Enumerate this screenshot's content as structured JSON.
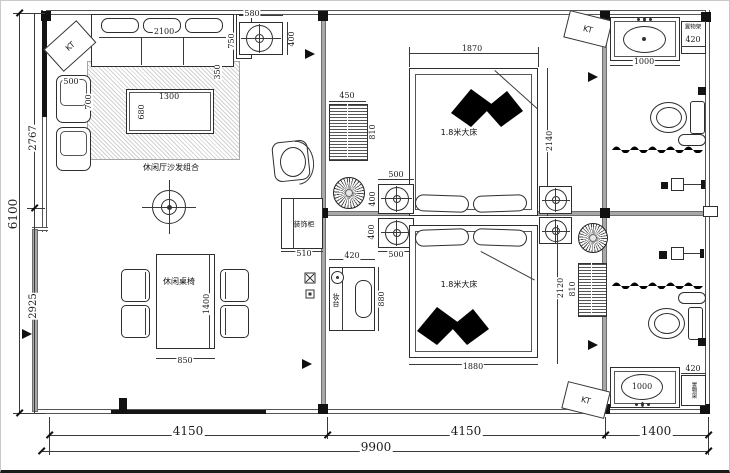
{
  "colors": {
    "curtain": "#3a56a8",
    "wall_gray": "#a8a8a8",
    "line": "#2e2e2e"
  },
  "living": {
    "label": "休闲厅沙发组合",
    "dining_label": "休闲桌椅",
    "kt": "KT",
    "dims": {
      "sofa_w": "2100",
      "sofa_d": "750",
      "sofa_s": "350",
      "spk_w": "580",
      "spk_h": "400",
      "chair_w": "500",
      "chair_d": "700",
      "table_w": "1300",
      "table_d": "680",
      "dining_w": "850",
      "dining_d": "1400"
    }
  },
  "bedroom1": {
    "bed_label": "1.8米大床",
    "kt": "KT",
    "dims": {
      "bed_w": "1870",
      "bed_d": "2140",
      "shelf_w": "450",
      "shelf_d": "810"
    }
  },
  "bedroom2": {
    "bed_label": "1.8米大床",
    "dresser_label": "妆台",
    "cabinet_label": "装饰柜",
    "dims": {
      "bed_w": "1880",
      "bed_d": "2120",
      "dresser_w": "420",
      "dresser_d": "880",
      "cabinet_w": "510",
      "shelf_d": "810"
    }
  },
  "speakers": {
    "dims": {
      "w_top": "500",
      "d_top": "400",
      "d_bot": "400",
      "w_bot": "500"
    }
  },
  "bath_top": {
    "rack_label": "置物架",
    "kt": "KT",
    "dims": {
      "vanity": "1000",
      "rack": "420"
    }
  },
  "bath_bottom": {
    "rack_label": "置物架",
    "kt": "KT",
    "dims": {
      "vanity": "1000",
      "rack": "420"
    }
  },
  "overall": {
    "dims": {
      "left_total": "6100",
      "left_top": "2767",
      "left_bottom": "2925",
      "bottom_left": "4150",
      "bottom_mid": "4150",
      "bottom_right": "1400",
      "bottom_total": "9900"
    }
  }
}
